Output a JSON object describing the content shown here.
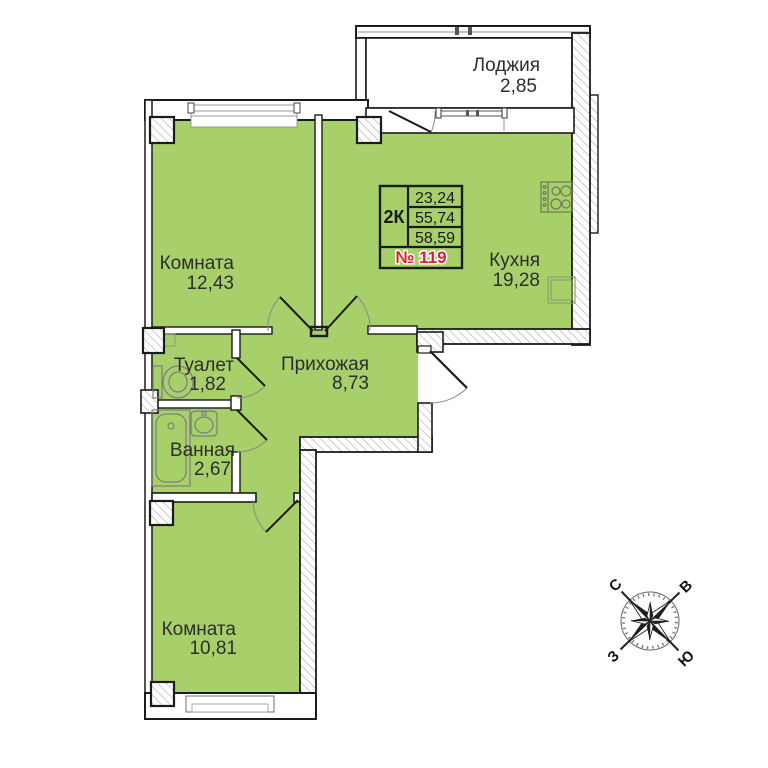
{
  "plan": {
    "rooms": [
      {
        "id": "loggia",
        "name": "Лоджия",
        "area": "2,85"
      },
      {
        "id": "room1",
        "name": "Комната",
        "area": "12,43"
      },
      {
        "id": "kitchen",
        "name": "Кухня",
        "area": "19,28"
      },
      {
        "id": "toilet",
        "name": "Туалет",
        "area": "1,82"
      },
      {
        "id": "hall",
        "name": "Прихожая",
        "area": "8,73"
      },
      {
        "id": "bath",
        "name": "Ванная",
        "area": "2,67"
      },
      {
        "id": "room2",
        "name": "Комната",
        "area": "10,81"
      }
    ],
    "info": {
      "type": "2К",
      "rows": [
        "23,24",
        "55,74",
        "58,59"
      ],
      "number": "№ 119"
    },
    "compass": {
      "n": "С",
      "e": "В",
      "s": "Ю",
      "w": "З"
    },
    "colors": {
      "floor_green": "#a7d06b",
      "wall_black": "#1b1b1b",
      "hatch_gray": "#a6a6a6",
      "number_red": "#e31e24"
    }
  }
}
